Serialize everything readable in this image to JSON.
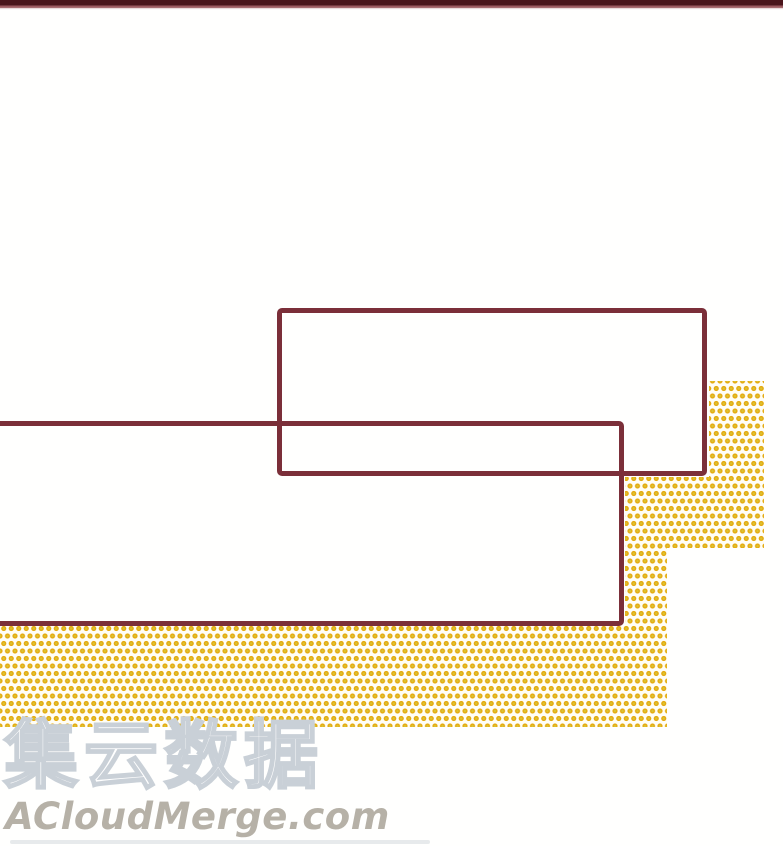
{
  "page": {
    "kind": "comic-page"
  },
  "panels": {
    "top_speech_box": {
      "text": ""
    },
    "bottom_speech_box": {
      "text": ""
    }
  },
  "watermark": {
    "site_name_cjk": "集云数据",
    "site_url": "ACloudMerge.com"
  },
  "colors": {
    "top_bar": "#4a151b",
    "top_bar_accent": "#9c5a60",
    "panel_border": "#7b2f39",
    "dot_ring": "#e6a90e",
    "dot_center": "#d9c433",
    "watermark_outline": "#c9d0d7",
    "watermark_url_text": "#b6b1a7"
  }
}
